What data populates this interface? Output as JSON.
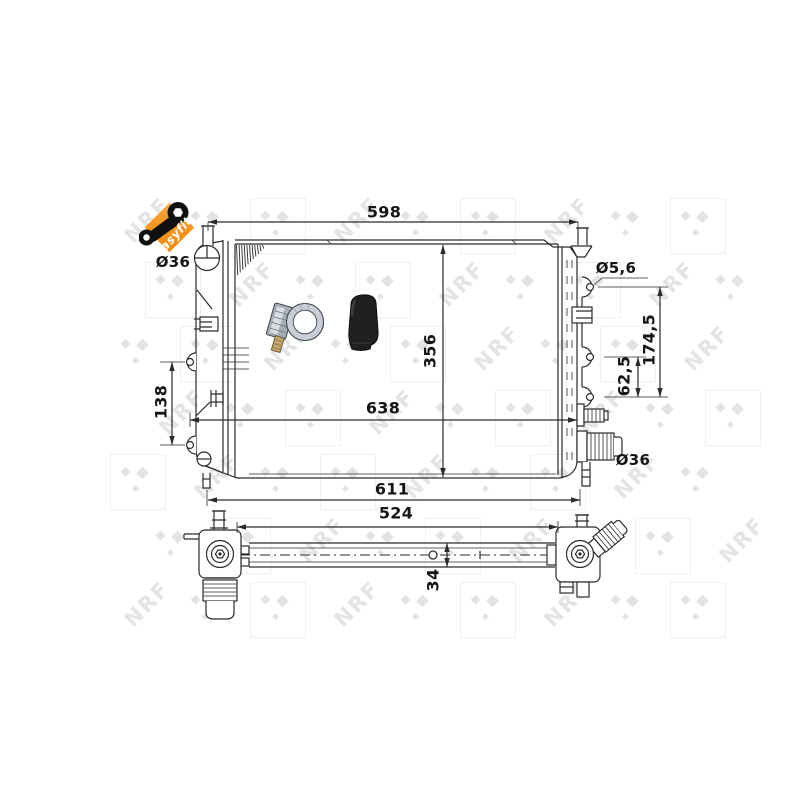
{
  "badge": {
    "label": "easyfit"
  },
  "watermark": {
    "text": "NRF"
  },
  "front_view": {
    "dim_top_width": "598",
    "dim_core_height": "356",
    "dim_overall_width": "638",
    "dim_lower_width": "611",
    "dim_left_mount_spacing": "138",
    "dim_inlet_diameter": "Ø36",
    "dim_mount_hole_diameter": "Ø5,6",
    "dim_right_mount_span": "174,5",
    "dim_right_mount_spacing": "62,5",
    "dim_outlet_diameter": "Ø36"
  },
  "bottom_view": {
    "dim_width": "524",
    "dim_depth": "34"
  },
  "colors": {
    "accent_orange": "#f7941d",
    "line": "#2b2b2b",
    "watermark_gray": "#e8e8e8"
  }
}
